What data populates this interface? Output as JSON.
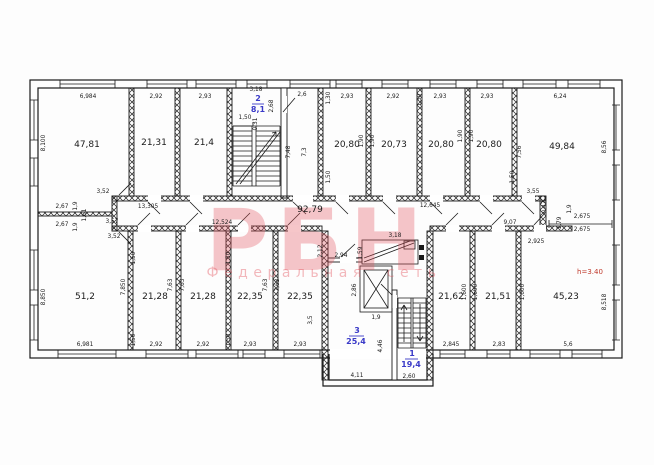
{
  "watermark": {
    "brand": "РБН",
    "tagline": "Федеральная сеть"
  },
  "annotations": {
    "ceiling_height": "h=3.40"
  },
  "palette": {
    "line": "#1b1b1b",
    "flat_label_blue": "#3a3ac8",
    "height_note_red": "#c0392b",
    "watermark_pink": "#e4505a"
  },
  "summary": {
    "top_row_room_areas": [
      "47,81",
      "21,31",
      "21,4",
      "20,80",
      "20,73",
      "20,80",
      "20,80",
      "49,84"
    ],
    "bottom_row_room_areas": [
      "51,2",
      "21,28",
      "21,28",
      "22,35",
      "22,35",
      "21,62",
      "21,51",
      "45,23"
    ],
    "corridor_area": "92,79",
    "numbered_spaces": [
      {
        "num": "2",
        "area": "8,1"
      },
      {
        "num": "3",
        "area": "25,4"
      },
      {
        "num": "1",
        "area": "19,4"
      }
    ],
    "top_dimensions": [
      "6,984",
      "2,92",
      "2,93",
      "3,18",
      "2,6",
      "2,93",
      "2,92",
      "2,93",
      "2,93",
      "6,24"
    ],
    "bottom_dimensions": [
      "6,981",
      "2,92",
      "2,92",
      "2,93",
      "2,93",
      "2,845",
      "2,83",
      "5,6",
      "4,11",
      "2,60"
    ],
    "side_dimensions": [
      "8,100",
      "8,850",
      "8,56",
      "8,518"
    ]
  },
  "labels": [
    {
      "t": "47,81",
      "x": 87,
      "y": 147,
      "c": "a"
    },
    {
      "t": "21,31",
      "x": 154,
      "y": 145,
      "c": "a"
    },
    {
      "t": "21,4",
      "x": 204,
      "y": 145,
      "c": "a"
    },
    {
      "t": "20,80",
      "x": 347,
      "y": 147,
      "c": "a"
    },
    {
      "t": "20,73",
      "x": 394,
      "y": 147,
      "c": "a"
    },
    {
      "t": "20,80",
      "x": 441,
      "y": 147,
      "c": "a"
    },
    {
      "t": "20,80",
      "x": 489,
      "y": 147,
      "c": "a"
    },
    {
      "t": "49,84",
      "x": 562,
      "y": 149,
      "c": "a"
    },
    {
      "t": "92,79",
      "x": 310,
      "y": 212,
      "c": "a"
    },
    {
      "t": "51,2",
      "x": 85,
      "y": 299,
      "c": "a"
    },
    {
      "t": "21,28",
      "x": 155,
      "y": 299,
      "c": "a"
    },
    {
      "t": "21,28",
      "x": 203,
      "y": 299,
      "c": "a"
    },
    {
      "t": "22,35",
      "x": 250,
      "y": 299,
      "c": "a"
    },
    {
      "t": "22,35",
      "x": 300,
      "y": 299,
      "c": "a"
    },
    {
      "t": "21,62",
      "x": 451,
      "y": 299,
      "c": "a"
    },
    {
      "t": "21,51",
      "x": 498,
      "y": 299,
      "c": "a"
    },
    {
      "t": "45,23",
      "x": 566,
      "y": 299,
      "c": "a"
    },
    {
      "t": "2",
      "x": 258,
      "y": 101,
      "c": "b"
    },
    {
      "t": "8,1",
      "x": 258,
      "y": 112,
      "c": "b"
    },
    {
      "t": "3",
      "x": 357,
      "y": 333,
      "c": "b"
    },
    {
      "t": "25,4",
      "x": 356,
      "y": 344,
      "c": "b"
    },
    {
      "t": "1",
      "x": 412,
      "y": 356,
      "c": "b"
    },
    {
      "t": "19,4",
      "x": 411,
      "y": 367,
      "c": "b"
    },
    {
      "t": "h=3.40",
      "x": 590,
      "y": 274,
      "c": "r"
    },
    {
      "t": "6,984",
      "x": 88,
      "y": 98
    },
    {
      "t": "2,92",
      "x": 156,
      "y": 98
    },
    {
      "t": "2,93",
      "x": 205,
      "y": 98
    },
    {
      "t": "3,18",
      "x": 256,
      "y": 91
    },
    {
      "t": "2,6",
      "x": 302,
      "y": 96
    },
    {
      "t": "2,93",
      "x": 347,
      "y": 98
    },
    {
      "t": "2,92",
      "x": 393,
      "y": 98
    },
    {
      "t": "2,93",
      "x": 440,
      "y": 98
    },
    {
      "t": "2,93",
      "x": 487,
      "y": 98
    },
    {
      "t": "6,24",
      "x": 560,
      "y": 98
    },
    {
      "t": "6,981",
      "x": 85,
      "y": 346
    },
    {
      "t": "2,92",
      "x": 156,
      "y": 346
    },
    {
      "t": "2,92",
      "x": 203,
      "y": 346
    },
    {
      "t": "2,93",
      "x": 250,
      "y": 346
    },
    {
      "t": "2,93",
      "x": 300,
      "y": 346
    },
    {
      "t": "2,845",
      "x": 451,
      "y": 346
    },
    {
      "t": "2,83",
      "x": 499,
      "y": 346
    },
    {
      "t": "5,6",
      "x": 568,
      "y": 346
    },
    {
      "t": "4,11",
      "x": 357,
      "y": 377
    },
    {
      "t": "2,60",
      "x": 409,
      "y": 378
    },
    {
      "t": "8,100",
      "x": 45,
      "y": 143,
      "r": 1
    },
    {
      "t": "8,850",
      "x": 45,
      "y": 297,
      "r": 1
    },
    {
      "t": "2,67",
      "x": 62,
      "y": 208
    },
    {
      "t": "2,67",
      "x": 62,
      "y": 226
    },
    {
      "t": "1,9",
      "x": 77,
      "y": 206,
      "r": 1
    },
    {
      "t": "1,61",
      "x": 86,
      "y": 215,
      "r": 1
    },
    {
      "t": "1,9",
      "x": 77,
      "y": 227,
      "r": 1
    },
    {
      "t": "8,56",
      "x": 606,
      "y": 147,
      "r": 1
    },
    {
      "t": "8,518",
      "x": 606,
      "y": 302,
      "r": 1
    },
    {
      "t": "2,675",
      "x": 582,
      "y": 218
    },
    {
      "t": "2,675",
      "x": 582,
      "y": 231
    },
    {
      "t": "1,79",
      "x": 561,
      "y": 223,
      "r": 1
    },
    {
      "t": "1,9",
      "x": 571,
      "y": 209,
      "r": 1
    },
    {
      "t": "0,47",
      "x": 546,
      "y": 207,
      "r": 1
    },
    {
      "t": "3,52",
      "x": 103,
      "y": 193
    },
    {
      "t": "13,305",
      "x": 148,
      "y": 208
    },
    {
      "t": "3,57",
      "x": 112,
      "y": 223
    },
    {
      "t": "3,52",
      "x": 114,
      "y": 238
    },
    {
      "t": "12,524",
      "x": 222,
      "y": 224
    },
    {
      "t": "12,645",
      "x": 430,
      "y": 207
    },
    {
      "t": "3,55",
      "x": 533,
      "y": 193
    },
    {
      "t": "9,07",
      "x": 510,
      "y": 224
    },
    {
      "t": "2,925",
      "x": 536,
      "y": 243
    },
    {
      "t": "1,50",
      "x": 245,
      "y": 119
    },
    {
      "t": "0,31",
      "x": 257,
      "y": 124,
      "r": 1
    },
    {
      "t": "2,68",
      "x": 273,
      "y": 106,
      "r": 1
    },
    {
      "t": "7,48",
      "x": 290,
      "y": 152,
      "r": 1
    },
    {
      "t": "7,3",
      "x": 306,
      "y": 152,
      "r": 1
    },
    {
      "t": "1,30",
      "x": 330,
      "y": 98,
      "r": 1
    },
    {
      "t": "1,30",
      "x": 421,
      "y": 100,
      "r": 1
    },
    {
      "t": "1,90",
      "x": 363,
      "y": 141,
      "r": 1
    },
    {
      "t": "1,90",
      "x": 374,
      "y": 141,
      "r": 1
    },
    {
      "t": "1,90",
      "x": 462,
      "y": 136,
      "r": 1
    },
    {
      "t": "1,90",
      "x": 473,
      "y": 136,
      "r": 1
    },
    {
      "t": "1,50",
      "x": 330,
      "y": 177,
      "r": 1
    },
    {
      "t": "1,50",
      "x": 514,
      "y": 177,
      "r": 1
    },
    {
      "t": "7,56",
      "x": 521,
      "y": 152,
      "r": 1
    },
    {
      "t": "7,63",
      "x": 172,
      "y": 285,
      "r": 1
    },
    {
      "t": "7,63",
      "x": 184,
      "y": 285,
      "r": 1
    },
    {
      "t": "7,63",
      "x": 267,
      "y": 285,
      "r": 1
    },
    {
      "t": "7,63",
      "x": 279,
      "y": 285,
      "r": 1
    },
    {
      "t": "7,850",
      "x": 125,
      "y": 287,
      "r": 1
    },
    {
      "t": "1,600",
      "x": 466,
      "y": 292,
      "r": 1
    },
    {
      "t": "1,600",
      "x": 477,
      "y": 292,
      "r": 1
    },
    {
      "t": "1,600",
      "x": 524,
      "y": 292,
      "r": 1
    },
    {
      "t": "1,50",
      "x": 135,
      "y": 258,
      "r": 1
    },
    {
      "t": "1,50",
      "x": 230,
      "y": 258,
      "r": 1
    },
    {
      "t": "1,50",
      "x": 135,
      "y": 340,
      "r": 1
    },
    {
      "t": "1,50",
      "x": 230,
      "y": 340,
      "r": 1
    },
    {
      "t": "2,94",
      "x": 341,
      "y": 257
    },
    {
      "t": "2,12",
      "x": 322,
      "y": 251,
      "r": 1
    },
    {
      "t": "3,5",
      "x": 312,
      "y": 320,
      "r": 1
    },
    {
      "t": "2,86",
      "x": 356,
      "y": 290,
      "r": 1
    },
    {
      "t": "1,9",
      "x": 376,
      "y": 319
    },
    {
      "t": "3,18",
      "x": 395,
      "y": 237
    },
    {
      "t": "1,59",
      "x": 362,
      "y": 253,
      "r": 1
    },
    {
      "t": "4,46",
      "x": 382,
      "y": 346,
      "r": 1
    }
  ]
}
